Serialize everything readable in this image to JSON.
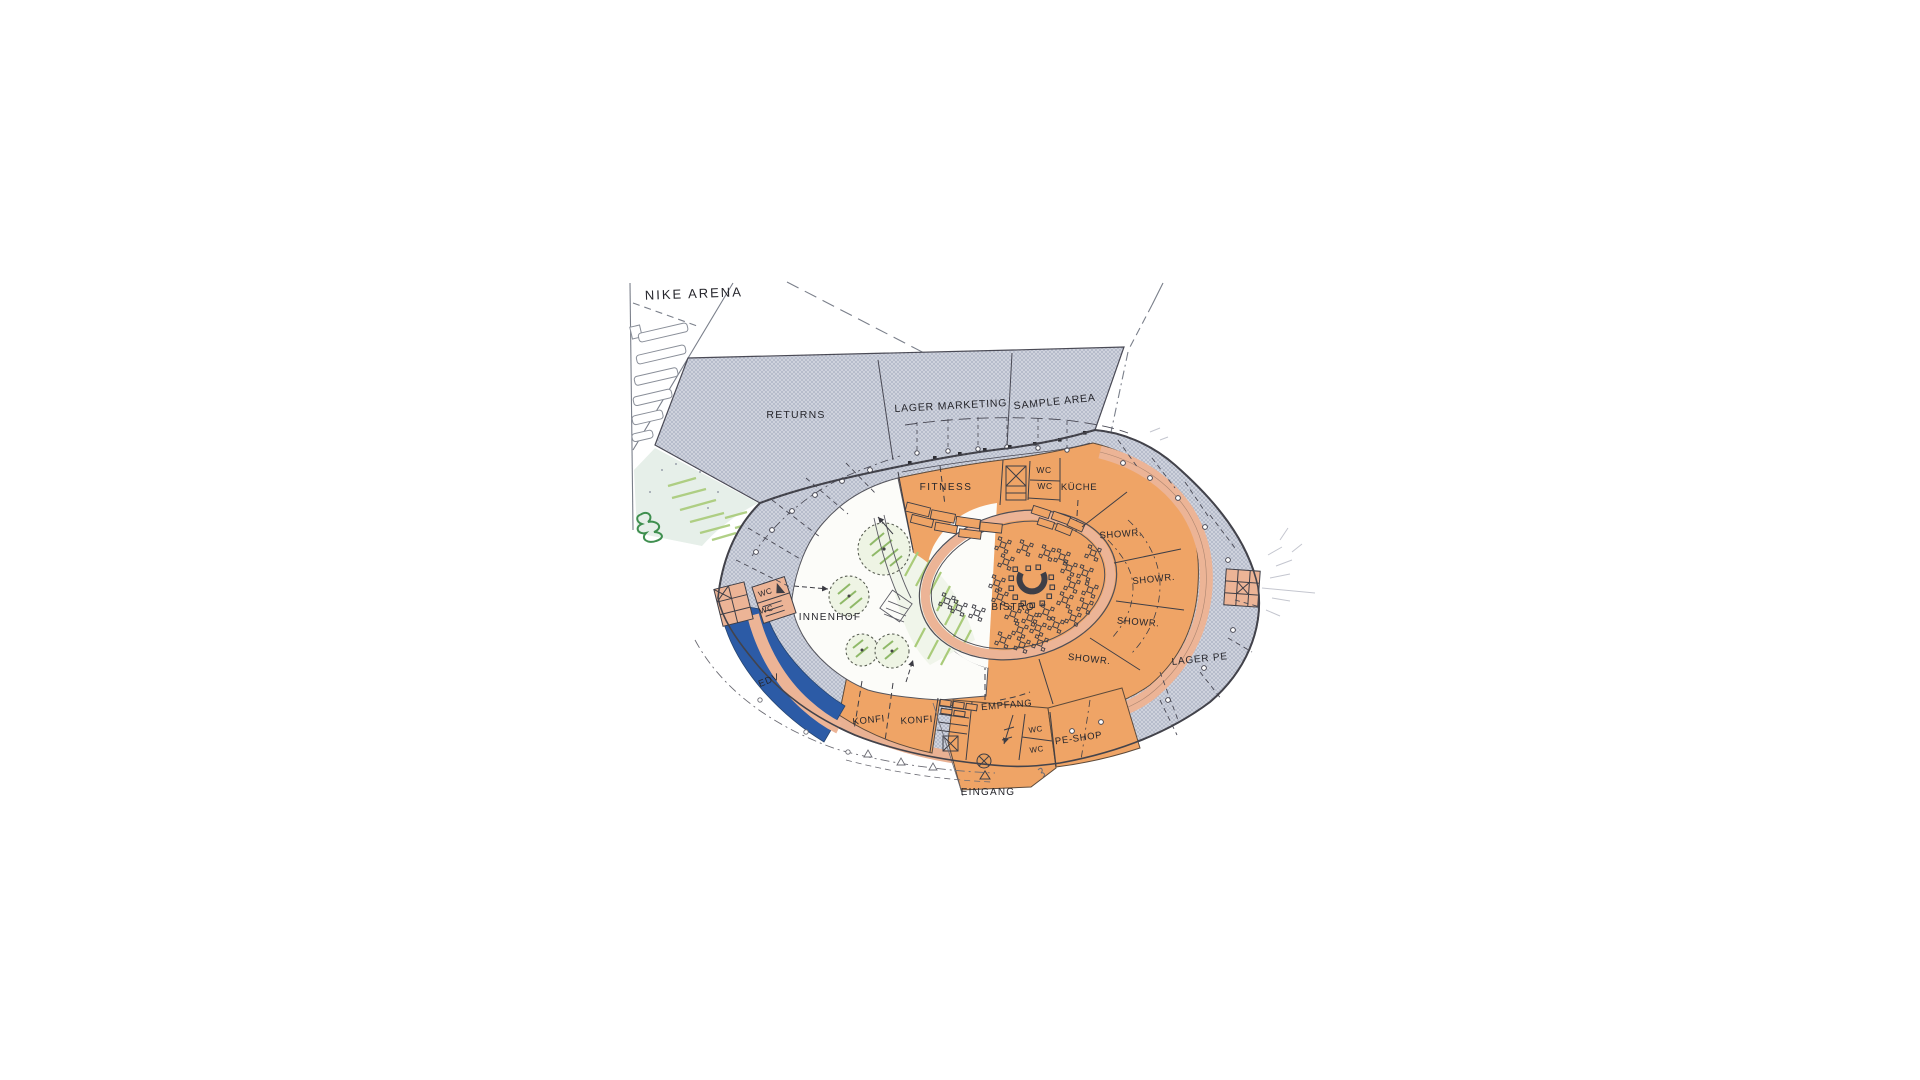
{
  "title": "NIKE ARENA",
  "drawing_type": "floor-plan",
  "colors": {
    "room_orange": "#efa466",
    "corridor_salmon": "#ecb496",
    "hatch_grey": "#b2b8c8",
    "edv_blue": "#2c5ba6",
    "landscape_green": "#a9cb79",
    "ink": "#26262c"
  },
  "labels": [
    {
      "id": "nike-arena",
      "text": "NIKE ARENA",
      "x": 694,
      "y": 298,
      "rot": -2,
      "size": 13,
      "ls": 2
    },
    {
      "id": "returns",
      "text": "RETURNS",
      "x": 796,
      "y": 418,
      "rot": 0,
      "size": 10.5,
      "ls": 1.2
    },
    {
      "id": "lager-marketing",
      "text": "LAGER MARKETING",
      "x": 951,
      "y": 409,
      "rot": -3,
      "size": 10.5,
      "ls": 0.8
    },
    {
      "id": "sample-area",
      "text": "SAMPLE AREA",
      "x": 1055,
      "y": 405,
      "rot": -6,
      "size": 10.5,
      "ls": 0.8
    },
    {
      "id": "fitness",
      "text": "FITNESS",
      "x": 946,
      "y": 490,
      "rot": 0,
      "size": 10,
      "ls": 1.5
    },
    {
      "id": "wc-kueche-1",
      "text": "WC",
      "x": 1044,
      "y": 473,
      "rot": 0,
      "size": 8.5,
      "ls": 0.5
    },
    {
      "id": "wc-kueche-2",
      "text": "WC",
      "x": 1045,
      "y": 489,
      "rot": 0,
      "size": 8.5,
      "ls": 0.5
    },
    {
      "id": "kueche",
      "text": "KÜCHE",
      "x": 1079,
      "y": 490,
      "rot": 0,
      "size": 9.5,
      "ls": 0.6
    },
    {
      "id": "showroom-1",
      "text": "SHOWR.",
      "x": 1121,
      "y": 537,
      "rot": -4,
      "size": 9.5,
      "ls": 0.6
    },
    {
      "id": "showroom-2",
      "text": "SHOWR.",
      "x": 1154,
      "y": 582,
      "rot": -6,
      "size": 9.5,
      "ls": 0.6
    },
    {
      "id": "showroom-3",
      "text": "SHOWR.",
      "x": 1138,
      "y": 625,
      "rot": 4,
      "size": 9.5,
      "ls": 0.6
    },
    {
      "id": "showroom-4",
      "text": "SHOWR.",
      "x": 1089,
      "y": 662,
      "rot": 6,
      "size": 9.5,
      "ls": 0.6
    },
    {
      "id": "bistro",
      "text": "BISTRO",
      "x": 1013,
      "y": 610,
      "rot": 0,
      "size": 10,
      "ls": 1
    },
    {
      "id": "innenhof",
      "text": "INNENHOF",
      "x": 830,
      "y": 620,
      "rot": 0,
      "size": 10,
      "ls": 1.3
    },
    {
      "id": "wc-left-1",
      "text": "WC",
      "x": 766,
      "y": 595,
      "rot": -18,
      "size": 8,
      "ls": 0.4
    },
    {
      "id": "wc-left-2",
      "text": "WC",
      "x": 767,
      "y": 612,
      "rot": -15,
      "size": 8,
      "ls": 0.4
    },
    {
      "id": "edv",
      "text": "EDV",
      "x": 770,
      "y": 683,
      "rot": -22,
      "size": 9.5,
      "ls": 0.8
    },
    {
      "id": "konfi-1",
      "text": "KONFI",
      "x": 869,
      "y": 723,
      "rot": -6,
      "size": 9.5,
      "ls": 0.7
    },
    {
      "id": "konfi-2",
      "text": "KONFI",
      "x": 917,
      "y": 723,
      "rot": -4,
      "size": 9.5,
      "ls": 0.7
    },
    {
      "id": "empfang",
      "text": "EMPFANG",
      "x": 1007,
      "y": 708,
      "rot": -5,
      "size": 9.5,
      "ls": 0.7
    },
    {
      "id": "wc-entrance-1",
      "text": "WC",
      "x": 1036,
      "y": 732,
      "rot": -8,
      "size": 8,
      "ls": 0.4
    },
    {
      "id": "wc-entrance-2",
      "text": "WC",
      "x": 1037,
      "y": 752,
      "rot": -8,
      "size": 8,
      "ls": 0.4
    },
    {
      "id": "pe-shop",
      "text": "PE-SHOP",
      "x": 1079,
      "y": 741,
      "rot": -8,
      "size": 9.5,
      "ls": 0.7
    },
    {
      "id": "lager-pe",
      "text": "LAGER PE",
      "x": 1200,
      "y": 662,
      "rot": -6,
      "size": 10,
      "ls": 0.8
    },
    {
      "id": "eingang",
      "text": "EINGANG",
      "x": 988,
      "y": 795,
      "rot": 0,
      "size": 10,
      "ls": 1.2
    }
  ]
}
